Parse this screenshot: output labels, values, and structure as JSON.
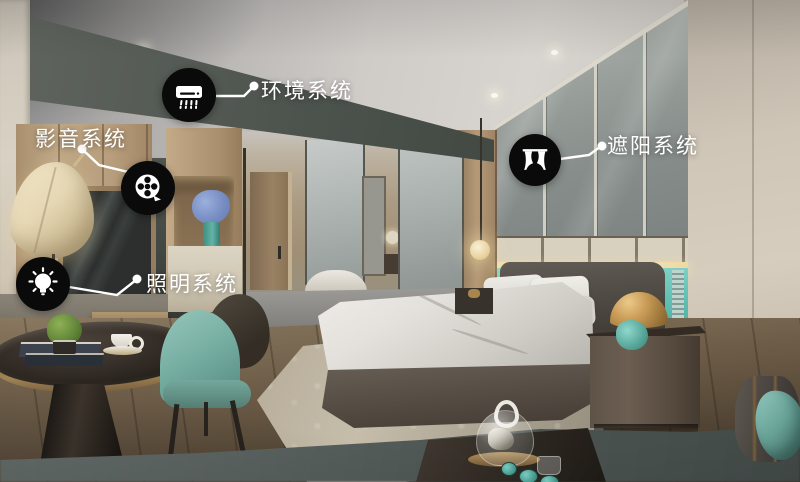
{
  "annotations": [
    {
      "id": "environment",
      "label": "环境系统",
      "icon": "air-conditioner-icon"
    },
    {
      "id": "audio-video",
      "label": "影音系统",
      "icon": "film-reel-icon"
    },
    {
      "id": "lighting",
      "label": "照明系统",
      "icon": "light-bulb-icon"
    },
    {
      "id": "shading",
      "label": "遮阳系统",
      "icon": "curtain-icon"
    }
  ],
  "colors": {
    "callout_circle": "#0a0a0a",
    "callout_text": "#ffffff",
    "connector": "#ffffff",
    "teal_accent_wall": "#5fc0b4",
    "teal_chair": "#79b0a4",
    "gold_lamp": "#b8904e",
    "ceiling_gray": "#c9c6c2",
    "dark_feature_wall": "#51564f",
    "wood_cabinet": "#b99f7e",
    "right_wall": "#cdc4b6",
    "bedding_white": "#e6e3de",
    "floor_wood": "#6d5d4a",
    "foreground_counter": "#596260"
  }
}
